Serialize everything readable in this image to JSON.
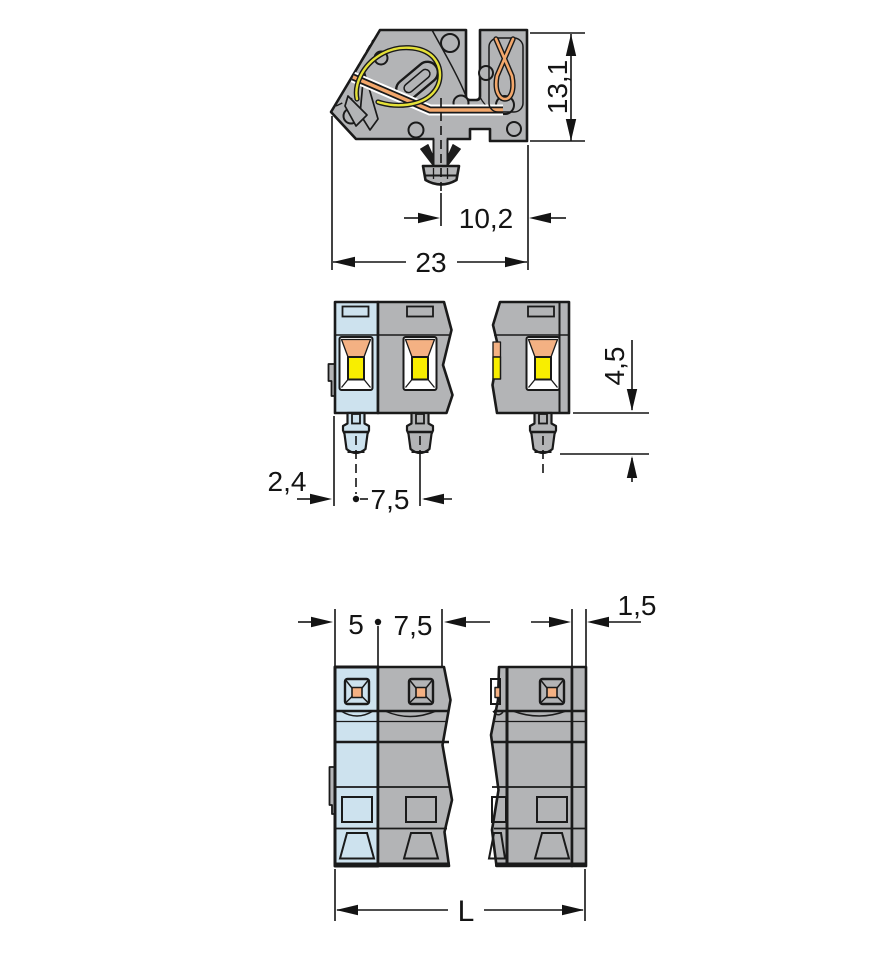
{
  "drawing_type": "connector-technical-drawing",
  "colors": {
    "housing_gray": "#b3b4b6",
    "pole_blue": "#cde2ee",
    "funnel_orange": "#f4b183",
    "entry_yellow": "#f8ee00",
    "spring_yellow": "#e5e138",
    "busbar_orange": "#f3a76b",
    "outline_dark": "#1a1a1a",
    "dim_color": "#141414",
    "paper_white": "#ffffff"
  },
  "views": {
    "side": "side-section-view",
    "front": "front-view",
    "bottom": "bottom-view"
  },
  "dims": {
    "side_height": "13,1",
    "side_foot_offset": "10,2",
    "side_depth": "23",
    "front_edge_to_pin": "2,4",
    "front_pin_pitch": "7,5",
    "front_pin_length": "4,5",
    "bottom_pole_width": "5",
    "bottom_pole_pitch": "7,5",
    "bottom_end_plate": "1,5",
    "bottom_total_length": "L"
  }
}
